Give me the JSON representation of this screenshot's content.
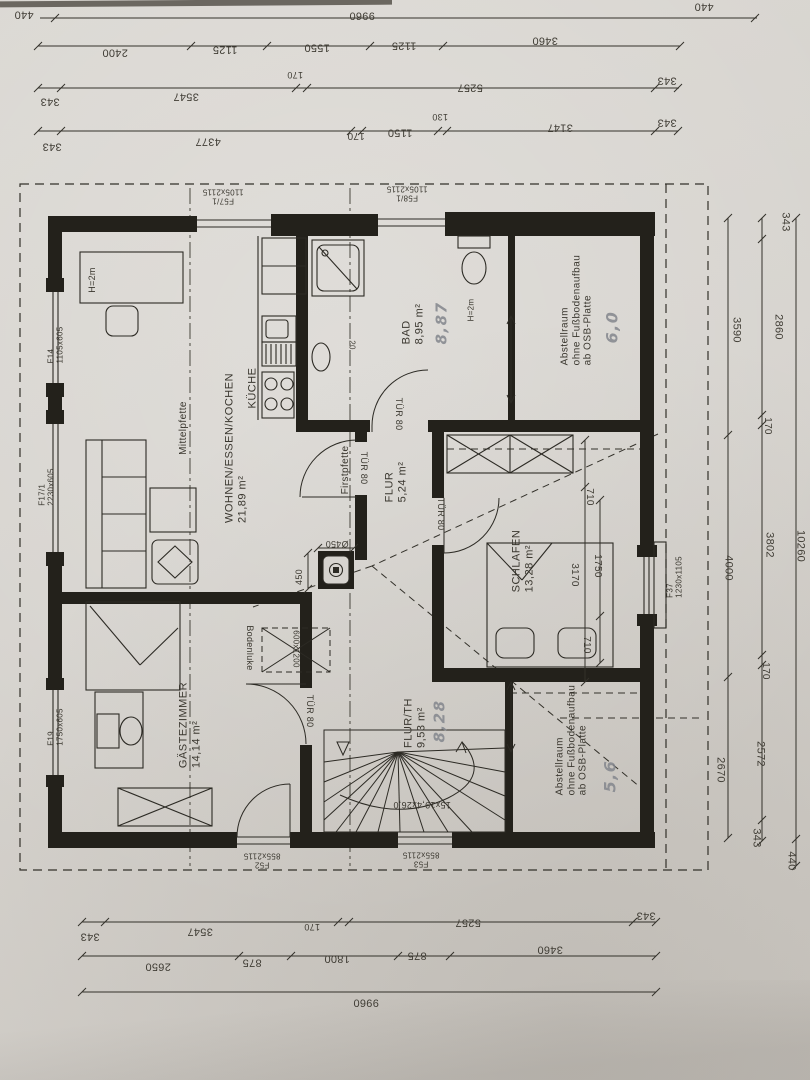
{
  "palette": {
    "paper": "#d7d4cf",
    "ink": "#2c2a24",
    "pencil": "#83868d"
  },
  "plan": {
    "rooms": [
      {
        "name": "WOHNEN/ESSEN/KOCHEN",
        "area": "21,89 m²"
      },
      {
        "name": "KÜCHE"
      },
      {
        "name": "BAD",
        "area": "8,95 m²",
        "handwritten": "8,87"
      },
      {
        "name": "Abstellraum",
        "note": "ohne Fußbodenaufbau ab OSB-Platte",
        "handwritten": "6,0"
      },
      {
        "name": "FLUR",
        "area": "5,24 m²"
      },
      {
        "name": "SCHLAFEN",
        "area": "13,28 m²"
      },
      {
        "name": "GÄSTEZIMMER",
        "area": "14,14 m²"
      },
      {
        "name": "FLUR/TH",
        "area": "9,53 m²",
        "handwritten": "8,28"
      },
      {
        "name": "Abstellraum",
        "note": "ohne Fußbodenaufbau ab OSB-Platte",
        "handwritten": "5,6"
      }
    ],
    "openings": [
      {
        "id": "F57/1",
        "size": "1105x2115"
      },
      {
        "id": "F58/1",
        "size": "1105x2115"
      },
      {
        "id": "F14",
        "size": "1105x605"
      },
      {
        "id": "F17/1",
        "size": "2230x605"
      },
      {
        "id": "F19",
        "size": "1750x605"
      },
      {
        "id": "F37",
        "size": "1230x1105"
      },
      {
        "id": "F52",
        "size": "855x2115"
      },
      {
        "id": "F53",
        "size": "855x2115"
      },
      {
        "id": "TÜR 80",
        "count": 4
      }
    ],
    "axes": [
      "Mittelpfette",
      "Firstpfette"
    ],
    "stair_label": "15x19,4x26,0",
    "notes": [
      "Bodenluke",
      "600x1200",
      "H=2m",
      "Ø450",
      "450",
      "20"
    ],
    "dimension_chains": {
      "top": [
        [
          "440",
          "9960",
          "440"
        ],
        [
          "2400",
          "1125",
          "1550",
          "1125",
          "3460"
        ],
        [
          "343",
          "3547",
          "170",
          "5257",
          "343"
        ],
        [
          "343",
          "4377",
          "170",
          "1150",
          "130",
          "3147",
          "343"
        ]
      ],
      "right": [
        [
          "3590",
          "4000",
          "2670"
        ],
        [
          "343",
          "2860",
          "170",
          "3802",
          "170",
          "2572",
          "343"
        ],
        [
          "10260",
          "440"
        ]
      ],
      "bottom": [
        [
          "343",
          "3547",
          "170",
          "5257",
          "343"
        ],
        [
          "2650",
          "875",
          "1800",
          "875",
          "3460"
        ],
        [
          "9960"
        ]
      ],
      "schlafen_interior": [
        [
          "710",
          "3170"
        ],
        [
          "1750",
          "710"
        ]
      ],
      "chimney": [
        "Ø450",
        "450"
      ]
    }
  },
  "annotations": [
    {
      "t": "440",
      "x": 24,
      "y": 14,
      "r": 180,
      "k": "dim"
    },
    {
      "t": "9960",
      "x": 362,
      "y": 15,
      "r": 180,
      "k": "dim"
    },
    {
      "t": "440",
      "x": 704,
      "y": 6,
      "r": 180,
      "k": "dim"
    },
    {
      "t": "2400",
      "x": 115,
      "y": 52,
      "r": 180,
      "k": "dim"
    },
    {
      "t": "1125",
      "x": 225,
      "y": 49,
      "r": 180,
      "k": "dim"
    },
    {
      "t": "1550",
      "x": 317,
      "y": 47,
      "r": 180,
      "k": "dim"
    },
    {
      "t": "1125",
      "x": 404,
      "y": 45,
      "r": 180,
      "k": "dim"
    },
    {
      "t": "3460",
      "x": 545,
      "y": 40,
      "r": 180,
      "k": "dim"
    },
    {
      "t": "343",
      "x": 50,
      "y": 101,
      "r": 180,
      "k": "dim"
    },
    {
      "t": "3547",
      "x": 186,
      "y": 96,
      "r": 180,
      "k": "dim"
    },
    {
      "t": "170",
      "x": 295,
      "y": 75,
      "r": 180,
      "s": 9,
      "k": "dim"
    },
    {
      "t": "5257",
      "x": 470,
      "y": 87,
      "r": 180,
      "k": "dim"
    },
    {
      "t": "343",
      "x": 667,
      "y": 80,
      "r": 180,
      "k": "dim"
    },
    {
      "t": "343",
      "x": 52,
      "y": 146,
      "r": 180,
      "k": "dim"
    },
    {
      "t": "4377",
      "x": 208,
      "y": 141,
      "r": 180,
      "k": "dim"
    },
    {
      "t": "170",
      "x": 356,
      "y": 135,
      "r": 180,
      "s": 10,
      "k": "dim"
    },
    {
      "t": "1150",
      "x": 400,
      "y": 132,
      "r": 180,
      "k": "dim"
    },
    {
      "t": "130",
      "x": 440,
      "y": 117,
      "r": 180,
      "s": 9,
      "k": "dim"
    },
    {
      "t": "3147",
      "x": 560,
      "y": 127,
      "r": 180,
      "k": "dim"
    },
    {
      "t": "343",
      "x": 667,
      "y": 122,
      "r": 180,
      "k": "dim"
    },
    {
      "t": "343",
      "x": 785,
      "y": 222,
      "r": 90,
      "k": "dim"
    },
    {
      "t": "3590",
      "x": 736,
      "y": 330,
      "r": 90,
      "k": "dim"
    },
    {
      "t": "2860",
      "x": 778,
      "y": 327,
      "r": 90,
      "k": "dim"
    },
    {
      "t": "170",
      "x": 767,
      "y": 426,
      "r": 90,
      "s": 10,
      "k": "dim"
    },
    {
      "t": "4000",
      "x": 728,
      "y": 568,
      "r": 90,
      "k": "dim"
    },
    {
      "t": "3802",
      "x": 769,
      "y": 545,
      "r": 90,
      "k": "dim"
    },
    {
      "t": "10260",
      "x": 800,
      "y": 546,
      "r": 90,
      "k": "dim"
    },
    {
      "t": "170",
      "x": 765,
      "y": 671,
      "r": 90,
      "s": 10,
      "k": "dim"
    },
    {
      "t": "2670",
      "x": 720,
      "y": 770,
      "r": 90,
      "k": "dim"
    },
    {
      "t": "2572",
      "x": 760,
      "y": 754,
      "r": 90,
      "k": "dim"
    },
    {
      "t": "343",
      "x": 756,
      "y": 838,
      "r": 90,
      "k": "dim"
    },
    {
      "t": "440",
      "x": 791,
      "y": 861,
      "r": 90,
      "k": "dim"
    },
    {
      "t": "343",
      "x": 90,
      "y": 936,
      "r": 180,
      "k": "dim"
    },
    {
      "t": "3547",
      "x": 200,
      "y": 931,
      "r": 180,
      "k": "dim"
    },
    {
      "t": "170",
      "x": 312,
      "y": 927,
      "r": 180,
      "s": 9,
      "k": "dim"
    },
    {
      "t": "5257",
      "x": 468,
      "y": 922,
      "r": 180,
      "k": "dim"
    },
    {
      "t": "343",
      "x": 646,
      "y": 915,
      "r": 180,
      "k": "dim"
    },
    {
      "t": "2650",
      "x": 158,
      "y": 966,
      "r": 180,
      "k": "dim"
    },
    {
      "t": "875",
      "x": 252,
      "y": 962,
      "r": 180,
      "k": "dim"
    },
    {
      "t": "1800",
      "x": 337,
      "y": 958,
      "r": 180,
      "k": "dim"
    },
    {
      "t": "875",
      "x": 417,
      "y": 955,
      "r": 180,
      "k": "dim"
    },
    {
      "t": "3460",
      "x": 550,
      "y": 949,
      "r": 180,
      "k": "dim"
    },
    {
      "t": "9960",
      "x": 366,
      "y": 1002,
      "r": 180,
      "k": "dim"
    },
    {
      "t": "710",
      "x": 589,
      "y": 497,
      "r": 90,
      "s": 10,
      "k": "dim"
    },
    {
      "t": "3170",
      "x": 574,
      "y": 575,
      "r": 90,
      "s": 10,
      "k": "dim"
    },
    {
      "t": "1750",
      "x": 597,
      "y": 566,
      "r": 90,
      "s": 10,
      "k": "dim"
    },
    {
      "t": "710",
      "x": 586,
      "y": 645,
      "r": 90,
      "s": 10,
      "k": "dim"
    },
    {
      "t": "450",
      "x": 299,
      "y": 577,
      "r": -90,
      "s": 9,
      "k": "dim"
    },
    {
      "t": "Ø450",
      "x": 337,
      "y": 544,
      "r": 180,
      "s": 9,
      "k": "dim"
    },
    {
      "t": "WOHNEN/ESSEN/KOCHEN\n21,89 m²",
      "x": 236,
      "y": 448,
      "r": -90,
      "k": "room",
      "n": "room-label-wohnen"
    },
    {
      "t": "KÜCHE",
      "x": 253,
      "y": 388,
      "r": -90,
      "k": "room",
      "n": "room-label-kueche"
    },
    {
      "t": "BAD\n8,95 m²",
      "x": 413,
      "y": 324,
      "r": -90,
      "k": "room",
      "n": "room-label-bad"
    },
    {
      "t": "Abstellraum\nohne Fußbodenaufbau\nab OSB-Platte",
      "x": 577,
      "y": 310,
      "r": -90,
      "s": 10,
      "k": "room",
      "n": "room-label-abstellraum-1"
    },
    {
      "t": "FLUR\n5,24 m²",
      "x": 396,
      "y": 482,
      "r": -90,
      "k": "room",
      "n": "room-label-flur"
    },
    {
      "t": "SCHLAFEN\n13,28 m²",
      "x": 523,
      "y": 561,
      "r": -90,
      "k": "room",
      "n": "room-label-schlafen"
    },
    {
      "t": "GÄSTEZIMMER\n14,14 m²",
      "x": 190,
      "y": 725,
      "r": -90,
      "k": "room",
      "n": "room-label-gaestezimmer"
    },
    {
      "t": "FLUR/TH\n9,53 m²",
      "x": 415,
      "y": 723,
      "r": -90,
      "k": "room",
      "n": "room-label-flur-th"
    },
    {
      "t": "Abstellraum\nohne Fußbodenaufbau\nab OSB-Platte",
      "x": 572,
      "y": 740,
      "r": -90,
      "s": 10,
      "k": "room",
      "n": "room-label-abstellraum-2"
    },
    {
      "t": "8,87",
      "x": 442,
      "y": 323,
      "r": -90,
      "s": 15,
      "k": "hand",
      "n": "handwritten-area"
    },
    {
      "t": "6,0",
      "x": 613,
      "y": 327,
      "r": -90,
      "s": 16,
      "k": "hand",
      "n": "handwritten-area"
    },
    {
      "t": "8,28",
      "x": 440,
      "y": 721,
      "r": -90,
      "s": 15,
      "k": "hand",
      "n": "handwritten-area"
    },
    {
      "t": "5,6",
      "x": 611,
      "y": 776,
      "r": -90,
      "s": 16,
      "k": "hand",
      "n": "handwritten-area"
    },
    {
      "t": "F14\n1105x605",
      "x": 56,
      "y": 345,
      "r": -90,
      "s": 8,
      "k": "open",
      "n": "window-label-f14"
    },
    {
      "t": "F17/1\n2230x605",
      "x": 47,
      "y": 487,
      "r": -90,
      "s": 8,
      "k": "open",
      "n": "window-label-f17"
    },
    {
      "t": "F19\n1750x605",
      "x": 56,
      "y": 727,
      "r": -90,
      "s": 8,
      "k": "open",
      "n": "window-label-f19"
    },
    {
      "t": "F37\n1230x1105",
      "x": 675,
      "y": 577,
      "r": -90,
      "s": 8,
      "k": "open",
      "n": "window-label-f37"
    },
    {
      "t": "F57/1\n1105x2115",
      "x": 223,
      "y": 196,
      "r": 180,
      "s": 8,
      "k": "open c",
      "n": "door-label-f57"
    },
    {
      "t": "F58/1\n1105x2115",
      "x": 407,
      "y": 193,
      "r": 180,
      "s": 8,
      "k": "open c",
      "n": "door-label-f58"
    },
    {
      "t": "F52\n855x2115",
      "x": 262,
      "y": 860,
      "r": 180,
      "s": 8,
      "k": "open c",
      "n": "door-label-f52"
    },
    {
      "t": "F53\n855x2115",
      "x": 421,
      "y": 859,
      "r": 180,
      "s": 8,
      "k": "open c",
      "n": "door-label-f53"
    },
    {
      "t": "TÜR 80",
      "x": 364,
      "y": 468,
      "r": 90,
      "s": 9,
      "k": "open",
      "n": "door-label-tuer80"
    },
    {
      "t": "TÜR 80",
      "x": 399,
      "y": 414,
      "r": 90,
      "s": 9,
      "k": "open",
      "n": "door-label-tuer80"
    },
    {
      "t": "TÜR 80",
      "x": 441,
      "y": 514,
      "r": 90,
      "s": 9,
      "k": "open",
      "n": "door-label-tuer80"
    },
    {
      "t": "TÜR 80",
      "x": 310,
      "y": 711,
      "r": 90,
      "s": 9,
      "k": "open",
      "n": "door-label-tuer80"
    },
    {
      "t": "Mittelpfette",
      "x": 184,
      "y": 428,
      "r": -90,
      "s": 10,
      "k": "axis",
      "n": "axis-label-mittelpfette"
    },
    {
      "t": "Firstpfette",
      "x": 346,
      "y": 470,
      "r": -90,
      "s": 10,
      "k": "axis",
      "n": "axis-label-firstpfette"
    },
    {
      "t": "Bodenluke",
      "x": 250,
      "y": 648,
      "r": 90,
      "s": 9,
      "k": "open",
      "n": "note-bodenluke"
    },
    {
      "t": "600x1200",
      "x": 296,
      "y": 649,
      "r": 90,
      "s": 8,
      "k": "open",
      "n": "note-bodenluke-size"
    },
    {
      "t": "H=2m",
      "x": 92,
      "y": 280,
      "r": -90,
      "s": 9,
      "k": "open",
      "n": "note-headroom"
    },
    {
      "t": "H=2m",
      "x": 471,
      "y": 310,
      "r": -90,
      "s": 8,
      "k": "open",
      "n": "note-headroom"
    },
    {
      "t": "15x19,4x26,0",
      "x": 422,
      "y": 805,
      "r": 180,
      "s": 9,
      "k": "open",
      "n": "stair-label"
    },
    {
      "t": "20",
      "x": 352,
      "y": 345,
      "r": 90,
      "s": 8,
      "k": "dim"
    }
  ],
  "dim_lines": [
    {
      "o": "h",
      "pos": 18,
      "a": 40,
      "b": 757,
      "ticks": [
        55,
        755
      ]
    },
    {
      "o": "h",
      "pos": 46,
      "a": 38,
      "b": 680,
      "ticks": [
        38,
        191,
        267,
        370,
        443,
        680
      ]
    },
    {
      "o": "h",
      "pos": 88,
      "a": 38,
      "b": 679,
      "ticks": [
        38,
        61,
        296,
        307,
        655,
        678
      ]
    },
    {
      "o": "h",
      "pos": 131,
      "a": 38,
      "b": 678,
      "ticks": [
        38,
        61,
        351,
        362,
        438,
        447,
        655,
        678
      ]
    },
    {
      "o": "v",
      "pos": 728,
      "a": 218,
      "b": 838,
      "ticks": [
        218,
        435,
        677,
        838
      ]
    },
    {
      "o": "v",
      "pos": 762,
      "a": 218,
      "b": 841,
      "ticks": [
        218,
        239,
        415,
        425,
        655,
        665,
        820,
        841
      ]
    },
    {
      "o": "v",
      "pos": 796,
      "a": 218,
      "b": 866,
      "ticks": [
        218,
        839,
        866
      ]
    },
    {
      "o": "h",
      "pos": 922,
      "a": 82,
      "b": 656,
      "ticks": [
        82,
        105,
        338,
        349,
        633,
        656
      ]
    },
    {
      "o": "h",
      "pos": 956,
      "a": 82,
      "b": 656,
      "ticks": [
        82,
        239,
        291,
        398,
        450,
        656
      ]
    },
    {
      "o": "h",
      "pos": 992,
      "a": 82,
      "b": 656,
      "ticks": [
        82,
        656
      ]
    },
    {
      "o": "v",
      "pos": 585,
      "a": 440,
      "b": 682,
      "ticks": [
        440,
        487,
        682
      ]
    },
    {
      "o": "v",
      "pos": 600,
      "a": 500,
      "b": 663,
      "ticks": [
        500,
        616,
        663
      ]
    },
    {
      "o": "h",
      "pos": 548,
      "a": 318,
      "b": 354,
      "ticks": [
        318,
        354
      ]
    },
    {
      "o": "v",
      "pos": 308,
      "a": 553,
      "b": 589,
      "ticks": [
        553,
        589
      ]
    }
  ]
}
